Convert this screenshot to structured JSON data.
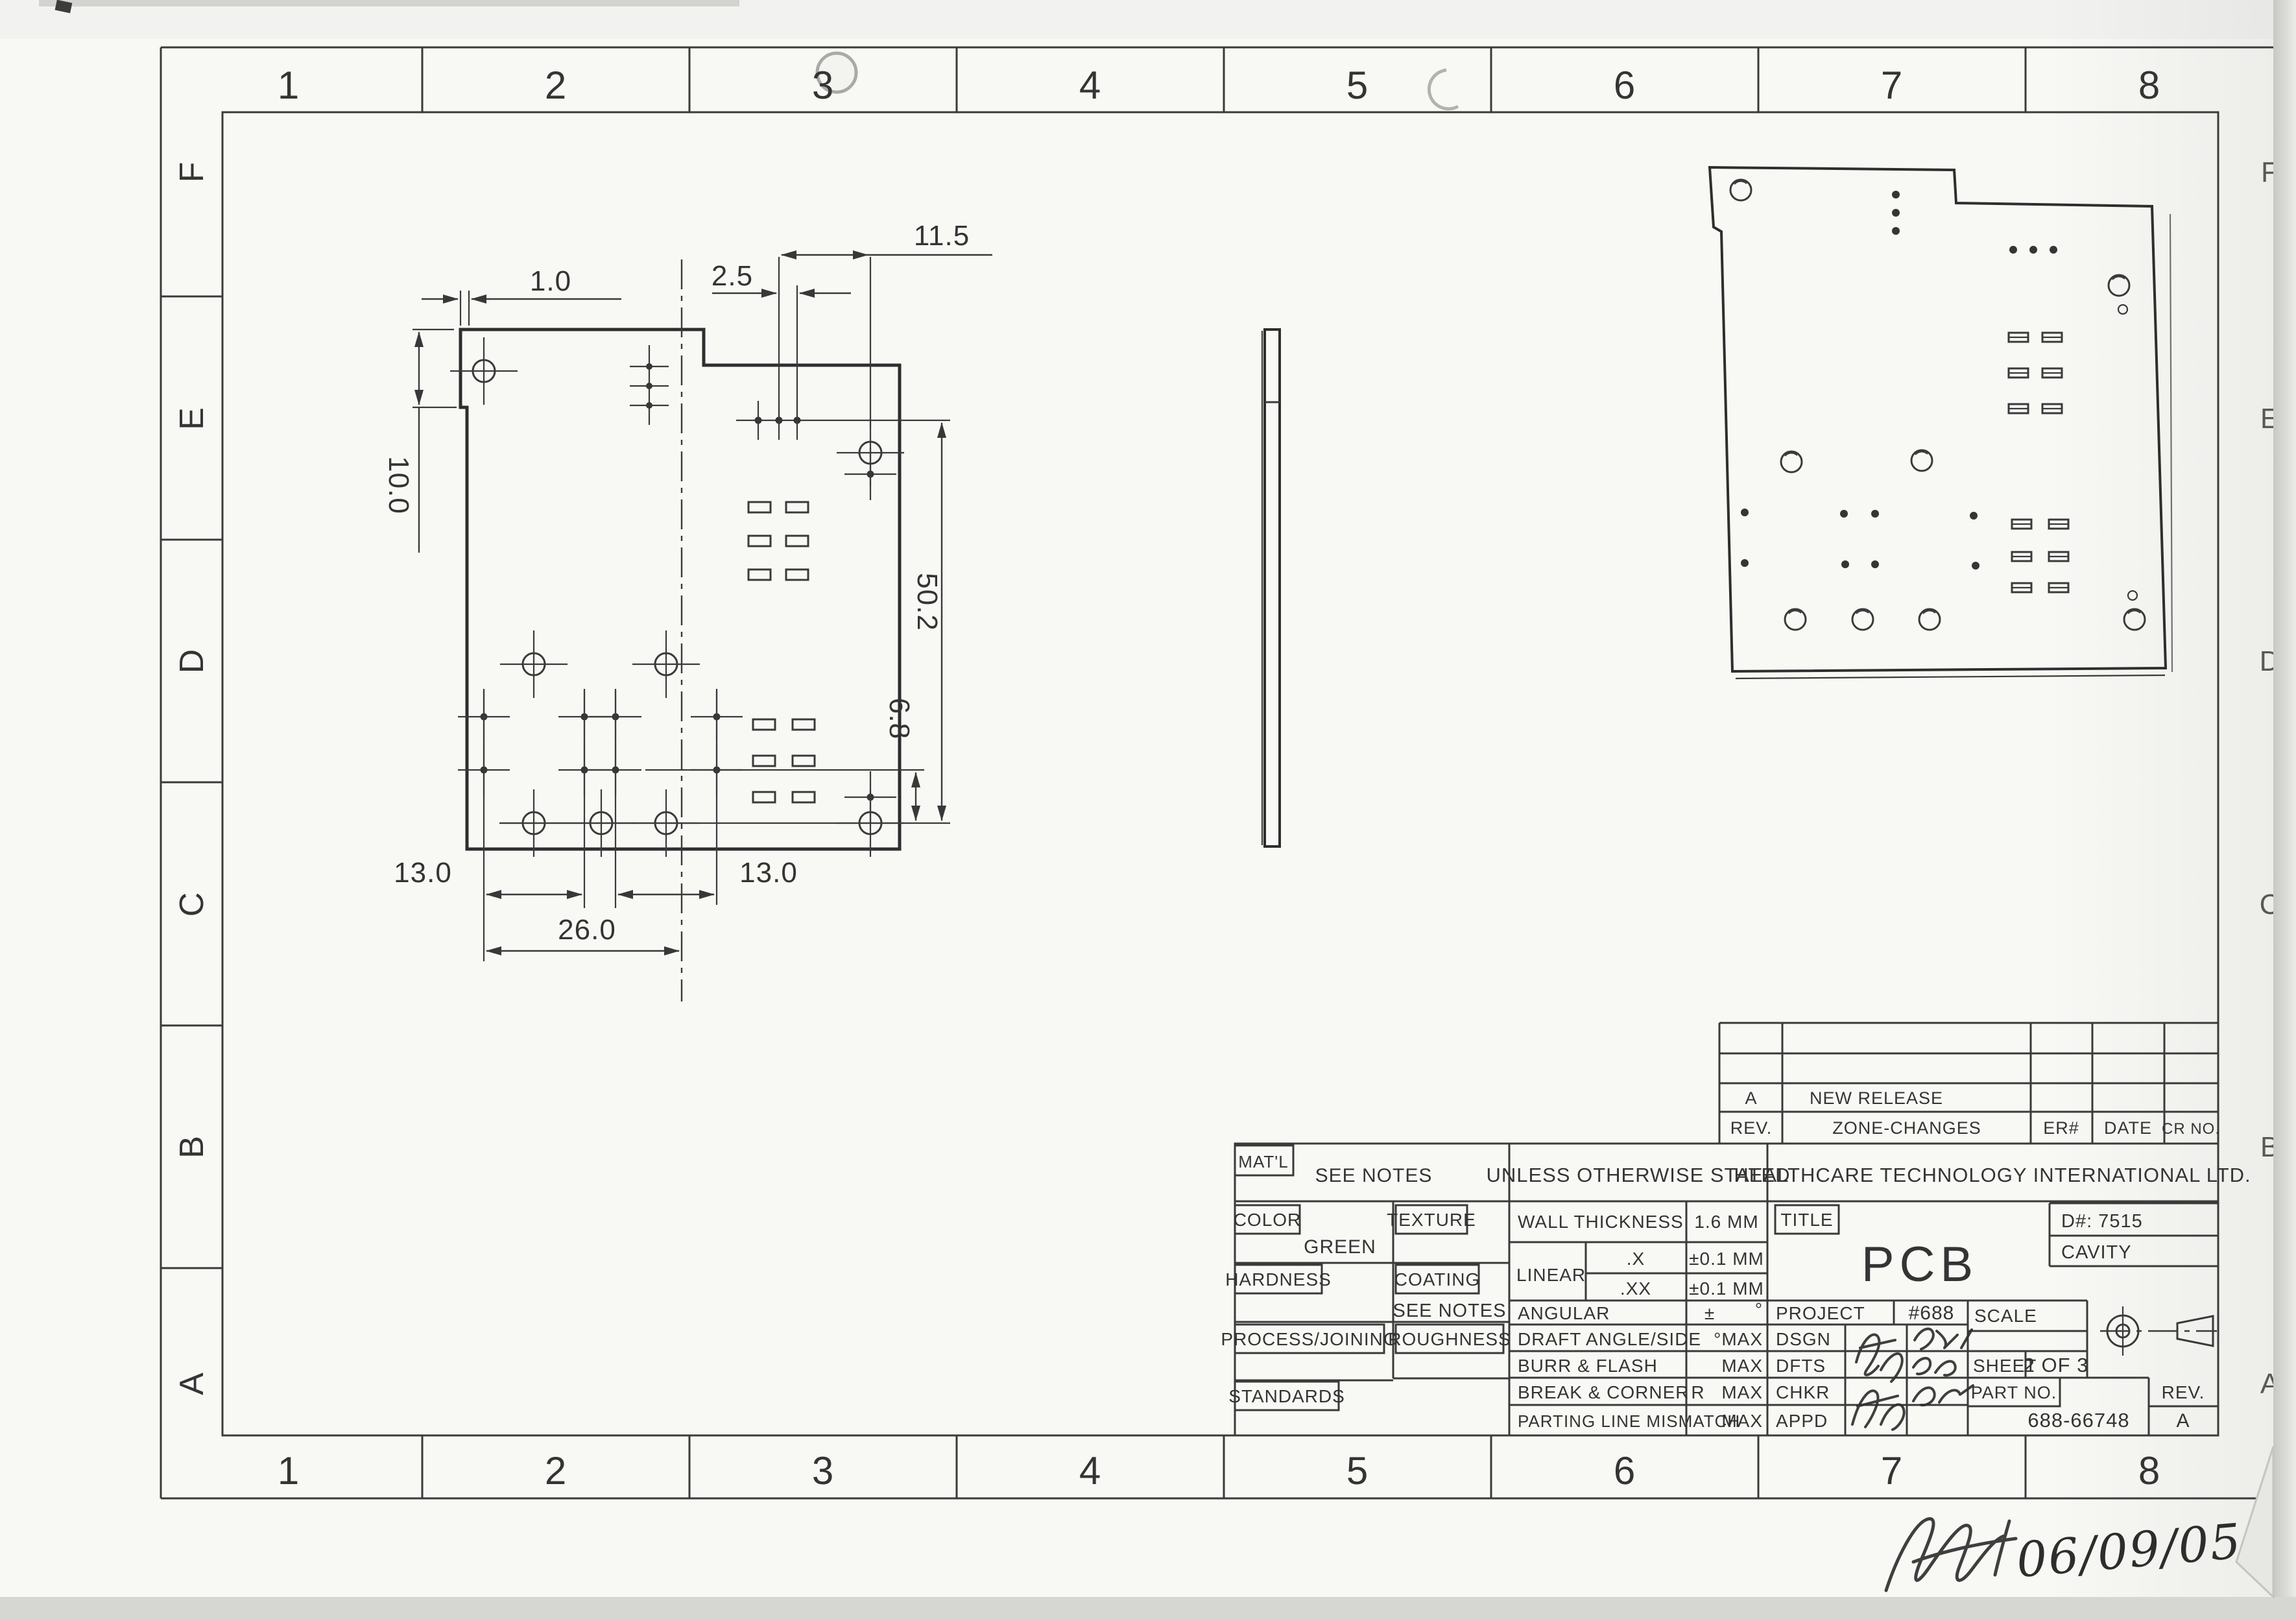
{
  "zones": {
    "top": [
      "1",
      "2",
      "3",
      "4",
      "5",
      "6",
      "7",
      "8"
    ],
    "bottom": [
      "1",
      "2",
      "3",
      "4",
      "5",
      "6",
      "7",
      "8"
    ],
    "left": [
      "F",
      "E",
      "D",
      "C",
      "B",
      "A"
    ],
    "right": [
      "F",
      "E",
      "D",
      "C",
      "B",
      "A"
    ]
  },
  "plan_view": {
    "dim_step_width": "1.0",
    "dim_step_height": "10.0",
    "dim_pad_pitch": "2.5",
    "dim_hole_offset": "11.5",
    "dim_height": "50.2",
    "dim_hole_row": "6.8",
    "dim_left_pitch": "13.0",
    "dim_right_pitch": "13.0",
    "dim_span": "26.0"
  },
  "revision_table": {
    "col_rev": "REV.",
    "col_zone": "ZONE-CHANGES",
    "col_er": "ER#",
    "col_date": "DATE",
    "col_cr": "CR NO.",
    "entry_rev": "A",
    "entry_desc": "NEW RELEASE"
  },
  "title_block": {
    "matl_label": "MAT'L",
    "matl_value": "SEE NOTES",
    "stated": "UNLESS OTHERWISE STATED",
    "company": "HEALTHCARE TECHNOLOGY INTERNATIONAL LTD.",
    "color_label": "COLOR",
    "color_value": "GREEN",
    "texture_label": "TEXTURE",
    "hardness_label": "HARDNESS",
    "coating_label": "COATING",
    "coating_value": "SEE NOTES",
    "process_label": "PROCESS/JOINING",
    "roughness_label": "ROUGHNESS",
    "standards_label": "STANDARDS",
    "wall_label": "WALL THICKNESS",
    "wall_value": "1.6 MM",
    "linear_label": "LINEAR",
    "linear_x": ".X",
    "linear_x_tol": "±0.1 MM",
    "linear_xx": ".XX",
    "linear_xx_tol": "±0.1 MM",
    "angular_label": "ANGULAR",
    "angular_pm": "±",
    "angular_deg": "°",
    "draft_label": "DRAFT ANGLE/SIDE",
    "draft_value": "°MAX",
    "burr_label": "BURR & FLASH",
    "burr_value": "MAX",
    "break_label": "BREAK & CORNER",
    "break_r": "R",
    "break_value": "MAX",
    "parting_label": "PARTING LINE MISMATCH",
    "parting_value": "MAX",
    "title_label": "TITLE",
    "title_value": "PCB",
    "d_number": "D#: 7515",
    "cavity": "CAVITY",
    "project_label": "PROJECT",
    "project_value": "#688",
    "scale_label": "SCALE",
    "sheet_label": "SHEET",
    "sheet_value": "2 OF 3",
    "dsgn_label": "DSGN",
    "dfts_label": "DFTS",
    "chkr_label": "CHKR",
    "appd_label": "APPD",
    "part_no_label": "PART NO.",
    "part_no_value": "688-66748",
    "rev_label": "REV.",
    "rev_value": "A"
  },
  "annotations": {
    "approval_date": "06/09/05"
  }
}
